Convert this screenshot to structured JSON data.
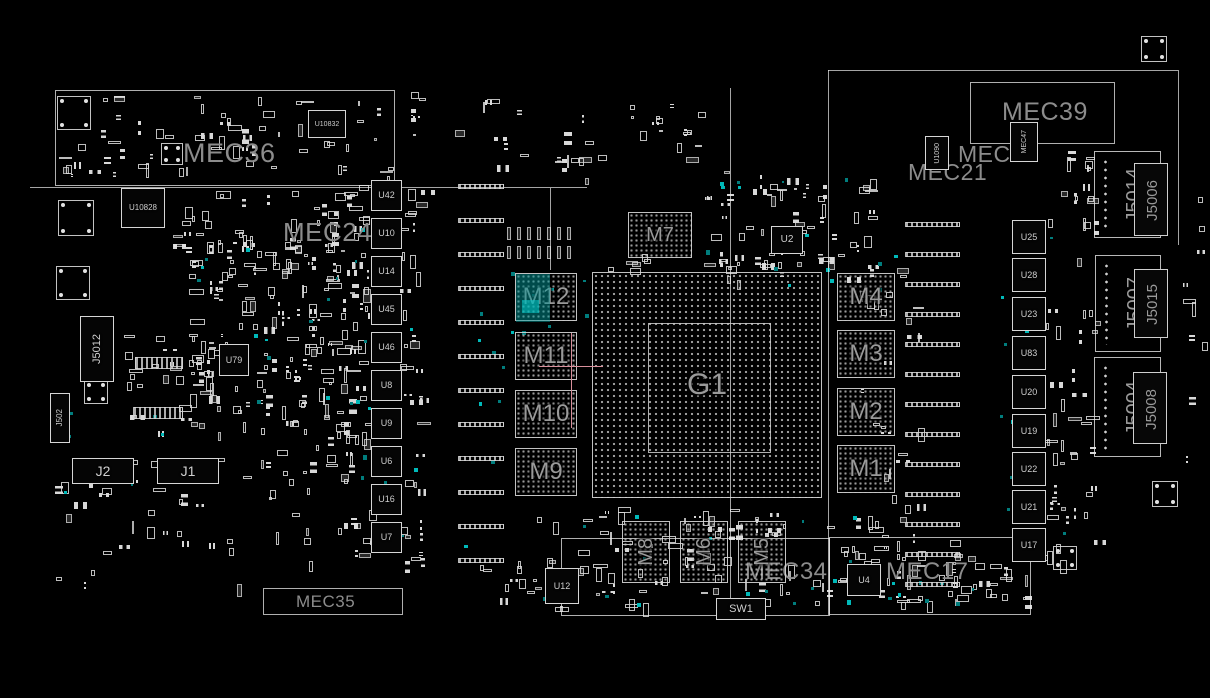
{
  "meta": {
    "view": "pcb-boardview",
    "background_color": "#000000",
    "outline_color": "#dedede",
    "region_label_color": "#8c8c8c",
    "ref_label_color": "#cfcfcf",
    "testpoint_color": "#00b9b9",
    "highlight_color": "#00a0a0",
    "crosshair_color": "#d88f9b"
  },
  "regions": [
    {
      "name": "mec36-box",
      "label": "MEC36",
      "x": 55,
      "y": 90,
      "w": 340,
      "h": 96,
      "lx": 128,
      "ly": 50,
      "fs": 27
    },
    {
      "name": "mec39-box",
      "label": "MEC39",
      "x": 970,
      "y": 82,
      "w": 145,
      "h": 62,
      "lx": 32,
      "ly": 18,
      "fs": 25
    },
    {
      "name": "mec17-box",
      "label": "MEC17",
      "x": 829,
      "y": 537,
      "w": 202,
      "h": 78,
      "lx": 57,
      "ly": 23,
      "fs": 24
    },
    {
      "name": "bottom-center-box",
      "label": "",
      "x": 561,
      "y": 538,
      "w": 269,
      "h": 78,
      "lx": 0,
      "ly": 0,
      "fs": 0
    },
    {
      "name": "mec35-box",
      "label": "MEC35",
      "x": 263,
      "y": 588,
      "w": 140,
      "h": 27,
      "lx": 33,
      "ly": 5,
      "fs": 17
    }
  ],
  "floating_labels": [
    {
      "name": "mec24-label",
      "text": "MEC24",
      "x": 283,
      "y": 219,
      "fs": 26
    },
    {
      "name": "mec25-label",
      "text": "MEC25",
      "x": 958,
      "y": 143,
      "fs": 23
    },
    {
      "name": "mec21-label",
      "text": "MEC21",
      "x": 908,
      "y": 161,
      "fs": 23
    },
    {
      "name": "mec34-label",
      "text": "MEC34",
      "x": 745,
      "y": 560,
      "fs": 24
    }
  ],
  "lines": [
    {
      "o": "h",
      "x": 30,
      "y": 187,
      "len": 557
    },
    {
      "o": "v",
      "x": 550,
      "y": 188,
      "len": 82
    },
    {
      "o": "v",
      "x": 730,
      "y": 88,
      "len": 528
    },
    {
      "o": "v",
      "x": 828,
      "y": 70,
      "len": 545
    },
    {
      "o": "h",
      "x": 828,
      "y": 70,
      "len": 350
    },
    {
      "o": "v",
      "x": 1178,
      "y": 70,
      "len": 175
    }
  ],
  "bgas": [
    {
      "ref": "G1",
      "x": 592,
      "y": 272,
      "w": 230,
      "h": 226,
      "fs": 30,
      "dot": 6,
      "inner": [
        55,
        50,
        123,
        130
      ]
    },
    {
      "ref": "M7",
      "x": 628,
      "y": 212,
      "w": 64,
      "h": 46,
      "fs": 20,
      "dot": 5
    },
    {
      "ref": "M4",
      "x": 837,
      "y": 273,
      "w": 58,
      "h": 48,
      "fs": 24,
      "dot": 5
    },
    {
      "ref": "M3",
      "x": 837,
      "y": 330,
      "w": 58,
      "h": 48,
      "fs": 24,
      "dot": 5
    },
    {
      "ref": "M2",
      "x": 837,
      "y": 388,
      "w": 58,
      "h": 48,
      "fs": 24,
      "dot": 5
    },
    {
      "ref": "M1",
      "x": 837,
      "y": 445,
      "w": 58,
      "h": 48,
      "fs": 24,
      "dot": 5
    },
    {
      "ref": "M12",
      "x": 515,
      "y": 273,
      "w": 62,
      "h": 48,
      "fs": 24,
      "dot": 5,
      "highlight": true
    },
    {
      "ref": "M11",
      "x": 515,
      "y": 332,
      "w": 62,
      "h": 48,
      "fs": 24,
      "dot": 5
    },
    {
      "ref": "M10",
      "x": 515,
      "y": 390,
      "w": 62,
      "h": 48,
      "fs": 24,
      "dot": 5
    },
    {
      "ref": "M9",
      "x": 515,
      "y": 448,
      "w": 62,
      "h": 48,
      "fs": 24,
      "dot": 5
    },
    {
      "ref": "M8",
      "x": 622,
      "y": 521,
      "w": 48,
      "h": 62,
      "fs": 20,
      "dot": 5,
      "vertical": true
    },
    {
      "ref": "M6",
      "x": 680,
      "y": 521,
      "w": 48,
      "h": 62,
      "fs": 20,
      "dot": 5,
      "vertical": true
    },
    {
      "ref": "M5",
      "x": 738,
      "y": 521,
      "w": 48,
      "h": 62,
      "fs": 20,
      "dot": 5,
      "vertical": true
    }
  ],
  "chips": [
    {
      "ref": "U10832",
      "x": 308,
      "y": 110,
      "w": 38,
      "h": 28,
      "fs": 7
    },
    {
      "ref": "U10828",
      "x": 121,
      "y": 188,
      "w": 44,
      "h": 40,
      "fs": 8
    },
    {
      "ref": "U79",
      "x": 219,
      "y": 344,
      "w": 30,
      "h": 32,
      "fs": 9
    },
    {
      "ref": "U2",
      "x": 771,
      "y": 226,
      "w": 32,
      "h": 28,
      "fs": 10
    },
    {
      "ref": "U1090",
      "x": 925,
      "y": 136,
      "w": 24,
      "h": 34,
      "fs": 7,
      "vertical": true
    },
    {
      "ref": "MEC47",
      "x": 1010,
      "y": 122,
      "w": 28,
      "h": 40,
      "fs": 7,
      "vertical": true
    },
    {
      "ref": "U4",
      "x": 847,
      "y": 564,
      "w": 34,
      "h": 32,
      "fs": 9
    },
    {
      "ref": "U12",
      "x": 545,
      "y": 568,
      "w": 34,
      "h": 36,
      "fs": 9
    },
    {
      "ref": "SW1",
      "x": 716,
      "y": 598,
      "w": 50,
      "h": 22,
      "fs": 11
    },
    {
      "ref": "J2",
      "x": 72,
      "y": 458,
      "w": 62,
      "h": 26,
      "fs": 14
    },
    {
      "ref": "J1",
      "x": 157,
      "y": 458,
      "w": 62,
      "h": 26,
      "fs": 14
    },
    {
      "ref": "J5012",
      "x": 80,
      "y": 316,
      "w": 34,
      "h": 66,
      "fs": 11,
      "vertical": true
    },
    {
      "ref": "J502",
      "x": 50,
      "y": 393,
      "w": 20,
      "h": 50,
      "fs": 8,
      "vertical": true
    }
  ],
  "vrm_columns": [
    {
      "name": "left-power-stage-column",
      "x": 371,
      "w": 31,
      "h": 31,
      "fs": 9,
      "ys": [
        180,
        218,
        256,
        294,
        332,
        370,
        408,
        446,
        484,
        522
      ],
      "labels": [
        "U42",
        "U10",
        "U14",
        "U45",
        "U46",
        "U8",
        "U9",
        "U6",
        "U16",
        "U7"
      ]
    },
    {
      "name": "right-power-stage-column",
      "x": 1012,
      "w": 34,
      "h": 34,
      "fs": 9,
      "ys": [
        220,
        258,
        297,
        336,
        375,
        414,
        452,
        490,
        528
      ],
      "labels": [
        "U25",
        "U28",
        "U23",
        "U83",
        "U20",
        "U19",
        "U22",
        "U21",
        "U17"
      ]
    }
  ],
  "connectors": [
    {
      "outer": {
        "label": "J5014",
        "x": 1094,
        "y": 151,
        "w": 67,
        "h": 87,
        "fs": 20
      },
      "inner": {
        "label": "J5006",
        "x": 1134,
        "y": 163,
        "w": 34,
        "h": 73,
        "fs": 15
      }
    },
    {
      "outer": {
        "label": "J5007",
        "x": 1095,
        "y": 255,
        "w": 66,
        "h": 97,
        "fs": 20
      },
      "inner": {
        "label": "J5015",
        "x": 1134,
        "y": 269,
        "w": 34,
        "h": 69,
        "fs": 15
      }
    },
    {
      "outer": {
        "label": "J5004",
        "x": 1094,
        "y": 357,
        "w": 67,
        "h": 100,
        "fs": 20
      },
      "inner": {
        "label": "J5008",
        "x": 1133,
        "y": 372,
        "w": 34,
        "h": 72,
        "fs": 15
      }
    }
  ],
  "mounts": [
    [
      57,
      96,
      34
    ],
    [
      58,
      200,
      36
    ],
    [
      56,
      266,
      34
    ],
    [
      84,
      380,
      24
    ],
    [
      161,
      143,
      22
    ],
    [
      1141,
      36,
      26
    ],
    [
      1152,
      481,
      26
    ],
    [
      1053,
      546,
      24
    ]
  ],
  "bars": {
    "left_column": {
      "x": 458,
      "w": 46,
      "h": 5,
      "y0": 184,
      "dy": 34,
      "count": 12
    },
    "right_column": {
      "x": 905,
      "w": 55,
      "h": 5,
      "y0": 222,
      "dy": 30,
      "count": 13
    },
    "misc": [
      [
        135,
        357,
        48,
        12
      ],
      [
        133,
        407,
        50,
        12
      ]
    ]
  },
  "pad_grid": {
    "x": 507,
    "y": 227,
    "cols": 7,
    "sx": 10,
    "rows": 2,
    "sy": 19,
    "w": 4,
    "h": 13
  },
  "crosshair": {
    "v": [
      571,
      333,
      95
    ],
    "h": [
      539,
      366,
      64
    ]
  }
}
